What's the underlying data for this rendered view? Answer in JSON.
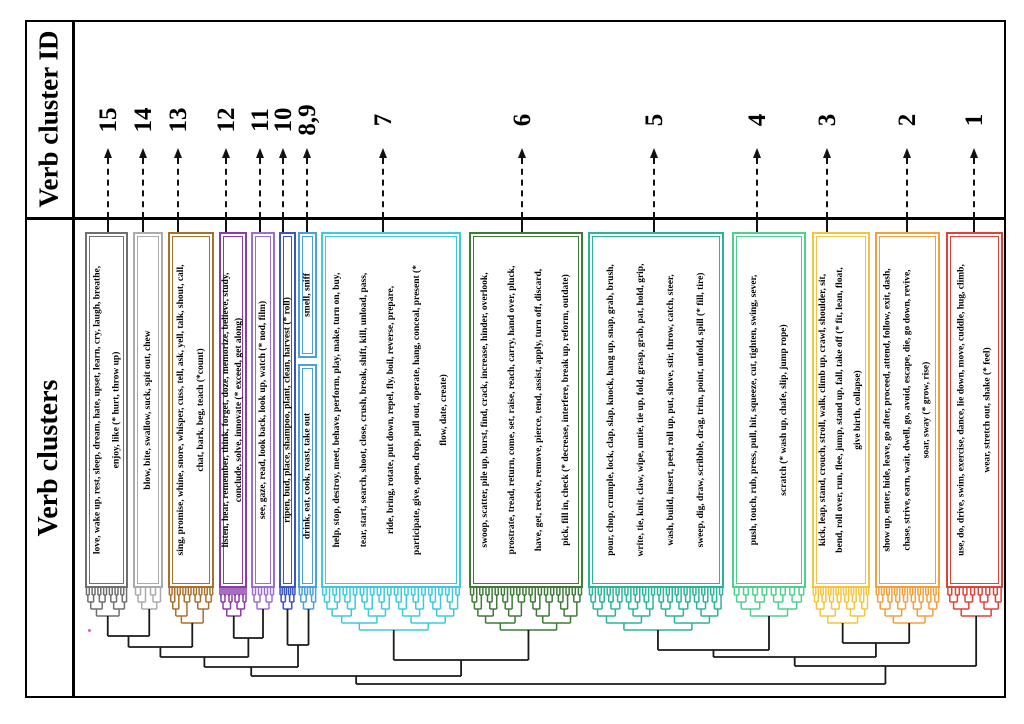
{
  "figure": {
    "row1_header": "Verb cluster ID",
    "row2_header": "Verb clusters"
  },
  "chart_data": {
    "type": "dendrogram",
    "title": "",
    "row_headers": [
      "Verb cluster ID",
      "Verb clusters"
    ],
    "cluster_id_order": [
      "15",
      "14",
      "13",
      "12",
      "11",
      "10",
      "8,9",
      "7",
      "6",
      "5",
      "4",
      "3",
      "2",
      "1"
    ],
    "clusters": [
      {
        "id": "15",
        "color": "#6f6f6f",
        "lines": [
          "love, wake up, rest, sleep, dream, hate, upset, learn, cry, laugh, breathe,",
          "enjoy, like (* hurt, throw up)"
        ]
      },
      {
        "id": "14",
        "color": "#ababab",
        "lines": [
          "blow, bite, swallow, suck, spit out, chew"
        ]
      },
      {
        "id": "13",
        "color": "#a8702d",
        "lines": [
          "sing, promise, whine, snore, whisper, cuss, tell, ask, yell, talk, shout, call,",
          "chat, bark, beg, teach (*count)"
        ]
      },
      {
        "id": "12",
        "color": "#8a3cad",
        "lines": [
          "listen, hear, remember, think, forget, doze, memorize, believe, study,",
          "conclude, solve, innovate (* exceed, get along)"
        ]
      },
      {
        "id": "11",
        "color": "#9a6fd4",
        "lines": [
          "see, gaze, read, look back, look up, watch (* nod, film)"
        ]
      },
      {
        "id": "10",
        "color": "#3b54c4",
        "lines": [
          "ripen, bud, place, shampoo, plant, clean, harvest (* roll)"
        ]
      },
      {
        "id": "9",
        "color": "#4b9ee0",
        "lines": [
          "smell, sniff"
        ]
      },
      {
        "id": "8",
        "color": "#4b9ee0",
        "lines": [
          "drink, eat, cook, roast, take out"
        ]
      },
      {
        "id": "7",
        "color": "#3ec9dc",
        "lines": [
          "help, stop, destroy, meet, behave, perform, play, make, turn on, buy,",
          "tear, start, search, shoot, close, crush, break, shift, kill, unload, pass,",
          "ride, bring, rotate, put down, repel, fly, boil, reverse, prepare,",
          "participate, give, open, drop, pull out, operate, hang, conceal, present (*",
          "flow, date, create)"
        ]
      },
      {
        "id": "6",
        "color": "#3f7a39",
        "lines": [
          "swoop, scatter, pile up, burst, find, crack, increase, hinder, overlook,",
          "prostrate, tread, return, come, set, raise, reach, carry, hand over, pluck,",
          "have, get, receive, remove, pierce, tend, assist, apply, turn off, discard,",
          "pick, fill in, check (* decrease, interfere, break up, reform, outdate)"
        ]
      },
      {
        "id": "5",
        "color": "#2cb39b",
        "lines": [
          "pour, chop, crumple, lock, clap, slap, knock, hang up, snap, grab, brush,",
          "write, tie, knit, claw, wipe, untie, tie up, fold, grasp, grab, pat, hold, grip,",
          "wash, build, insert, peel, roll up, put, shove, stir, throw, catch, steer,",
          "sweep, dig, draw, scribble, drag, trim, point, unfold, spill (* fill, tire)"
        ]
      },
      {
        "id": "4",
        "color": "#4ed18f",
        "lines": [
          "push, touch, rub, press, pull, hit, squeeze, cut, tighten, swing, sever,",
          "scratch (* wash up, chafe, slip, jump rope)"
        ]
      },
      {
        "id": "3",
        "color": "#f3c440",
        "lines": [
          "kick, leap, stand, crouch, stroll, walk, climb up, crawl, shoulder, sit,",
          "bend, roll over, run, flee, jump, stand up, fall, take off (* fit, lean, float,",
          "give birth, collapse)"
        ]
      },
      {
        "id": "2",
        "color": "#f2a03c",
        "lines": [
          "show up, enter, hide, leave, go after, proceed, attend, follow, exit, dash,",
          "chase, strive, earn, wait, dwell, go, avoid, escape, die, go down, revive,",
          "soar, sway (* grow, rise)"
        ]
      },
      {
        "id": "1",
        "color": "#df4238",
        "lines": [
          "use, do, drive, swim, exercise, dance, lie down, move, cuddle, hug, climb,",
          "wear, stretch out, shake (* feel)"
        ]
      }
    ]
  },
  "layout": {
    "cluster_ids": [
      {
        "label": "15",
        "x": 108
      },
      {
        "label": "14",
        "x": 143
      },
      {
        "label": "13",
        "x": 178
      },
      {
        "label": "12",
        "x": 226
      },
      {
        "label": "11",
        "x": 260
      },
      {
        "label": "10",
        "x": 283
      },
      {
        "label": "8,9",
        "x": 307
      },
      {
        "label": "7",
        "x": 383
      },
      {
        "label": "6",
        "x": 522
      },
      {
        "label": "5",
        "x": 654
      },
      {
        "label": "4",
        "x": 757
      },
      {
        "label": "3",
        "x": 827
      },
      {
        "label": "2",
        "x": 907
      },
      {
        "label": "1",
        "x": 974
      }
    ],
    "boxes": [
      {
        "cluster": "15",
        "x": 85,
        "y": 232,
        "w": 43,
        "h": 356
      },
      {
        "cluster": "14",
        "x": 133,
        "y": 232,
        "w": 30,
        "h": 356
      },
      {
        "cluster": "13",
        "x": 168,
        "y": 232,
        "w": 46,
        "h": 356
      },
      {
        "cluster": "12",
        "x": 219,
        "y": 232,
        "w": 28,
        "h": 356
      },
      {
        "cluster": "11",
        "x": 251,
        "y": 232,
        "w": 24,
        "h": 356
      },
      {
        "cluster": "10",
        "x": 279,
        "y": 232,
        "w": 17,
        "h": 356
      },
      {
        "cluster": "9",
        "x": 298,
        "y": 232,
        "w": 19,
        "h": 126
      },
      {
        "cluster": "8",
        "x": 298,
        "y": 364,
        "w": 19,
        "h": 224
      },
      {
        "cluster": "7",
        "x": 321,
        "y": 232,
        "w": 140,
        "h": 356
      },
      {
        "cluster": "6",
        "x": 469,
        "y": 232,
        "w": 114,
        "h": 356
      },
      {
        "cluster": "5",
        "x": 588,
        "y": 232,
        "w": 136,
        "h": 356
      },
      {
        "cluster": "4",
        "x": 732,
        "y": 232,
        "w": 74,
        "h": 356
      },
      {
        "cluster": "3",
        "x": 812,
        "y": 232,
        "w": 58,
        "h": 356
      },
      {
        "cluster": "2",
        "x": 875,
        "y": 232,
        "w": 65,
        "h": 356
      },
      {
        "cluster": "1",
        "x": 946,
        "y": 232,
        "w": 57,
        "h": 356
      }
    ],
    "dendrogram": {
      "leaf_y": 588,
      "step": 7,
      "bottom": 684,
      "subtrees": [
        {
          "node": "c15",
          "x0": 85,
          "x1": 128,
          "n": 15,
          "color": "#6f6f6f"
        },
        {
          "node": "c14",
          "x0": 133,
          "x1": 163,
          "n": 6,
          "color": "#ababab"
        },
        {
          "node": "c13",
          "x0": 168,
          "x1": 214,
          "n": 17,
          "color": "#a8702d"
        },
        {
          "node": "c12",
          "x0": 219,
          "x1": 247,
          "n": 14,
          "color": "#8a3cad"
        },
        {
          "node": "c11",
          "x0": 251,
          "x1": 275,
          "n": 8,
          "color": "#9a6fd4"
        },
        {
          "node": "c10",
          "x0": 279,
          "x1": 296,
          "n": 8,
          "color": "#3b54c4"
        },
        {
          "node": "c89",
          "x0": 298,
          "x1": 317,
          "n": 7,
          "color": "#4b9ee0"
        },
        {
          "node": "c7",
          "x0": 321,
          "x1": 461,
          "n": 41,
          "color": "#3ec9dc"
        },
        {
          "node": "c6",
          "x0": 469,
          "x1": 583,
          "n": 37,
          "color": "#3f7a39"
        },
        {
          "node": "c5",
          "x0": 588,
          "x1": 724,
          "n": 46,
          "color": "#2cb39b"
        },
        {
          "node": "c4",
          "x0": 732,
          "x1": 806,
          "n": 16,
          "color": "#4ed18f"
        },
        {
          "node": "c3",
          "x0": 812,
          "x1": 870,
          "n": 23,
          "color": "#f3c440"
        },
        {
          "node": "c2",
          "x0": 875,
          "x1": 940,
          "n": 25,
          "color": "#f2a03c"
        },
        {
          "node": "c1",
          "x0": 946,
          "x1": 1003,
          "n": 15,
          "color": "#df4238"
        }
      ],
      "merges": [
        [
          "m0",
          636,
          "c15",
          "c14"
        ],
        [
          "m1",
          647,
          "m0",
          "c13"
        ],
        [
          "m2",
          638,
          "c12",
          "c11"
        ],
        [
          "m3",
          657,
          "m1",
          "m2"
        ],
        [
          "m4",
          645,
          "c10",
          "c89"
        ],
        [
          "m5",
          667,
          "m3",
          "m4"
        ],
        [
          "m6",
          660,
          "c7",
          "c6"
        ],
        [
          "m7",
          676,
          "m5",
          "m6"
        ],
        [
          "m8",
          650,
          "c5",
          "c4"
        ],
        [
          "m9",
          643,
          "c3",
          "c2"
        ],
        [
          "m10",
          657,
          "m8",
          "m9"
        ],
        [
          "m11",
          666,
          "m10",
          "c1"
        ],
        [
          "root",
          684,
          "m7",
          "m11"
        ]
      ]
    }
  }
}
